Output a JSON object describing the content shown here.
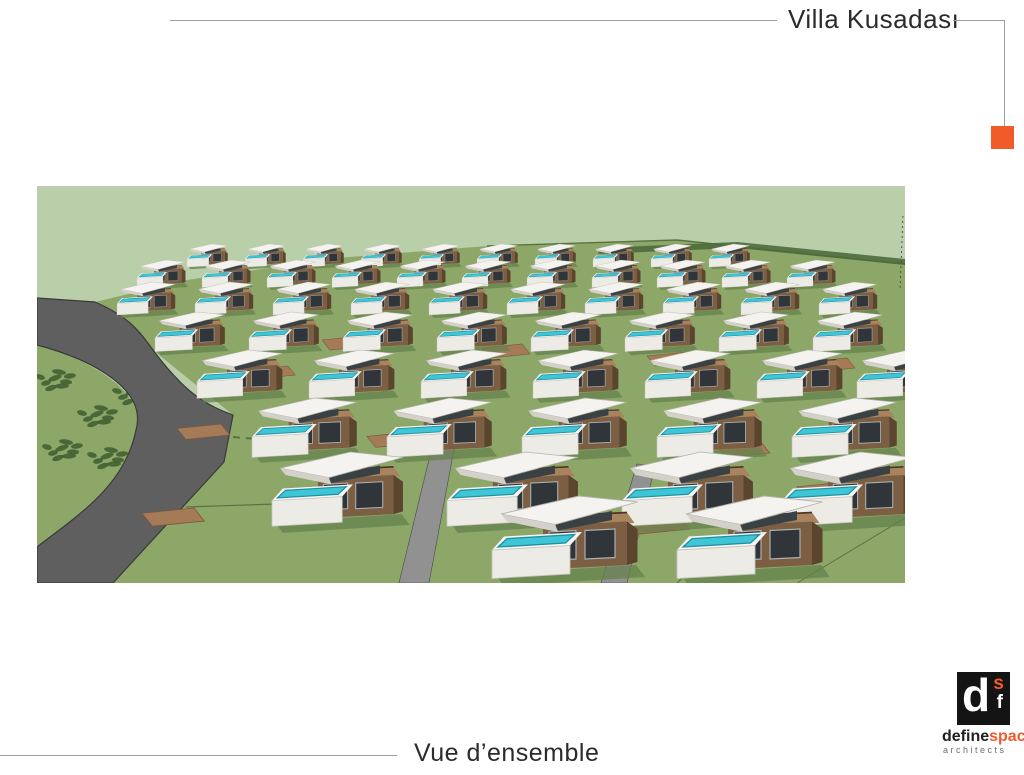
{
  "slide": {
    "title": "Villa Kusadası",
    "caption": "Vue d’ensemble",
    "figure_description": "Aerial 3D rendering of a hillside villa development: rows of modern villas with white angular roofs, wooden terraces and turquoise rooftop pools, green lawns, and a curving grey access road"
  },
  "logo": {
    "monogram_d": "d",
    "monogram_s": "s",
    "monogram_f": "f",
    "word_define": "define",
    "word_space": "space",
    "subtitle": "architects"
  },
  "colors": {
    "accent_orange": "#f15a29",
    "rule_gray": "#9d9d9d",
    "text_dark": "#2b2b2b",
    "logo_gray": "#6d6e71"
  },
  "figure_palette": {
    "field_light": "#b8cfa9",
    "field_mid": "#8ca768",
    "field_line": "#5a7243",
    "hedge": "#4e6a3c",
    "tree": "#3e5c2f",
    "road_dark": "#5f5f5f",
    "road_edge": "#3a3a3a",
    "road_light": "#919191",
    "dirt": "#a57a57",
    "dirt_edge": "#7a573b",
    "roof_white": "#f4f3ef",
    "roof_shade": "#d3d1ca",
    "deck_white": "#edebe5",
    "deck_top": "#f8f7f3",
    "wood": "#a8835d",
    "wall": "#7c5e42",
    "wall_dark": "#5b452f",
    "window": "#2f3538",
    "window_frame": "#a9afb2",
    "pool": "#3fc6d6",
    "pool_dark": "#1e91a3",
    "shadow_green": "#66824d"
  }
}
